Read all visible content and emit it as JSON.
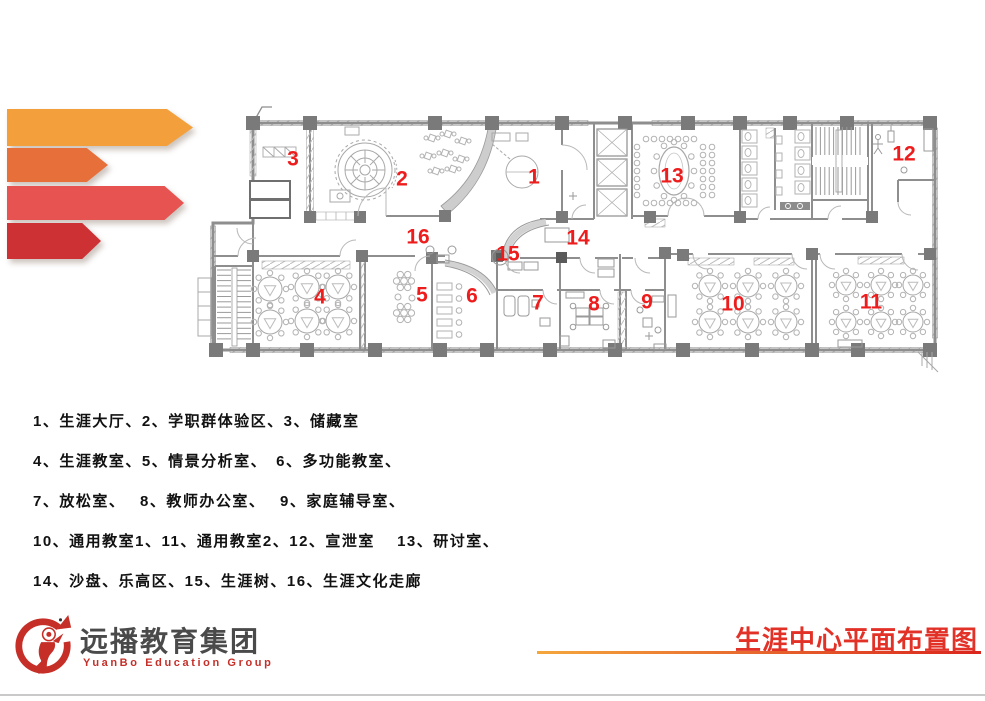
{
  "decor": {
    "arrow_colors": [
      "#f3a03c",
      "#e7703a",
      "#e75351",
      "#cd3134"
    ]
  },
  "floor_plan": {
    "label_color": "#ee1d1d",
    "room_labels": [
      {
        "num": "1",
        "x": 534,
        "y": 177
      },
      {
        "num": "2",
        "x": 402,
        "y": 179
      },
      {
        "num": "3",
        "x": 293,
        "y": 159
      },
      {
        "num": "4",
        "x": 320,
        "y": 297
      },
      {
        "num": "5",
        "x": 422,
        "y": 295
      },
      {
        "num": "6",
        "x": 472,
        "y": 296
      },
      {
        "num": "7",
        "x": 538,
        "y": 303
      },
      {
        "num": "8",
        "x": 594,
        "y": 304
      },
      {
        "num": "9",
        "x": 647,
        "y": 302
      },
      {
        "num": "10",
        "x": 733,
        "y": 304
      },
      {
        "num": "11",
        "x": 871,
        "y": 302
      },
      {
        "num": "12",
        "x": 904,
        "y": 154
      },
      {
        "num": "13",
        "x": 672,
        "y": 176
      },
      {
        "num": "14",
        "x": 578,
        "y": 238
      },
      {
        "num": "15",
        "x": 508,
        "y": 254
      },
      {
        "num": "16",
        "x": 418,
        "y": 237
      }
    ]
  },
  "legend": {
    "lines": [
      "1、生涯大厅、2、学职群体验区、3、储藏室",
      "4、生涯教室、5、情景分析室、　6、多功能教室、",
      "7、放松室、　 8、教师办公室、　 9、家庭辅导室、",
      "10、通用教室1、11、通用教室2、12、宣泄室　 13、研讨室、",
      "14、沙盘、乐高区、15、生涯树、16、生涯文化走廊"
    ]
  },
  "footer": {
    "logo_cn": "远播教育集团",
    "logo_en": "YuanBo Education Group",
    "title": "生涯中心平面布置图",
    "title_color": "#e23228"
  }
}
